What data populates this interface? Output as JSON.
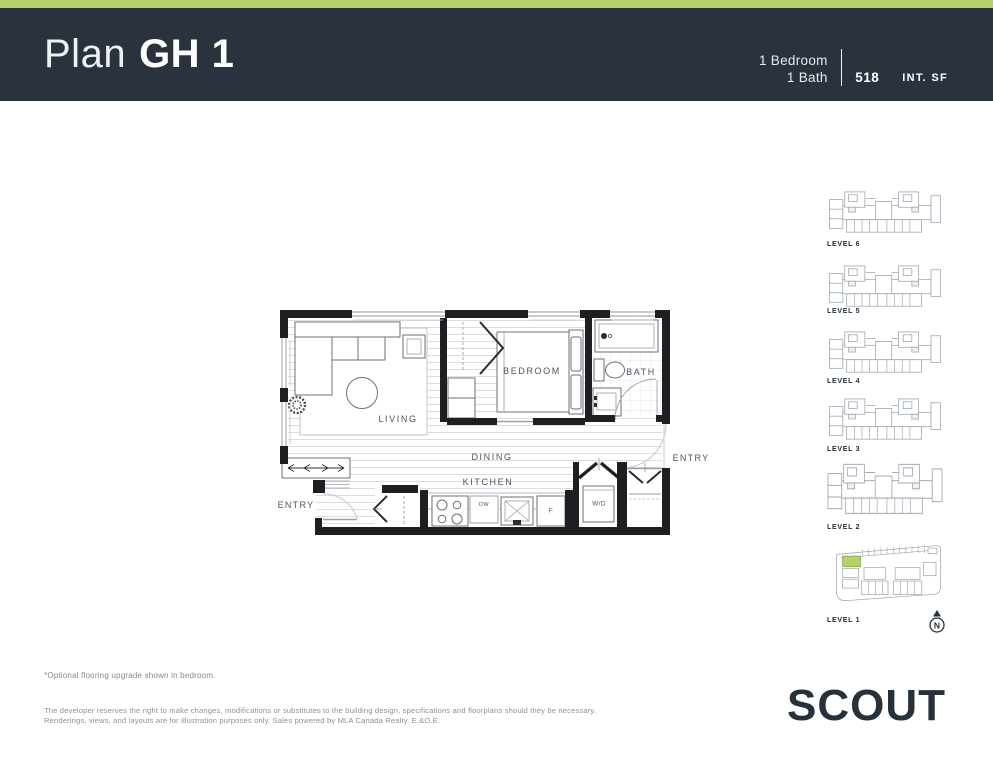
{
  "header": {
    "plan_label": "Plan",
    "plan_name": "GH 1",
    "bedrooms": "1 Bedroom",
    "baths": "1 Bath",
    "area_value": "518",
    "area_unit": "INT. SF"
  },
  "floorplan": {
    "living": "LIVING",
    "bedroom": "BEDROOM",
    "bath": "BATH",
    "dining": "DINING",
    "kitchen": "KITCHEN",
    "entry_left": "ENTRY",
    "entry_right": "ENTRY",
    "washer_dryer": "W/D",
    "dishwasher": "DW",
    "fridge": "F"
  },
  "levels": [
    {
      "label": "LEVEL 6"
    },
    {
      "label": "LEVEL 5"
    },
    {
      "label": "LEVEL 4"
    },
    {
      "label": "LEVEL 3"
    },
    {
      "label": "LEVEL 2"
    },
    {
      "label": "LEVEL 1"
    }
  ],
  "north_label": "N",
  "footnote": "*Optional flooring upgrade shown in bedroom.",
  "disclaimer_line1": "The developer reserves the right to make changes, modifications or substitutes to the building design, specifications and floorplans should they be necessary.",
  "disclaimer_line2": "Renderings, views, and layouts are for illustration purposes only. Sales powered by MLA Canada Realty. E.&O.E.",
  "logo": "SCOUT",
  "colors": {
    "accent": "#b5d26a",
    "header_bg": "#2a333d",
    "ink": "#27313b"
  }
}
